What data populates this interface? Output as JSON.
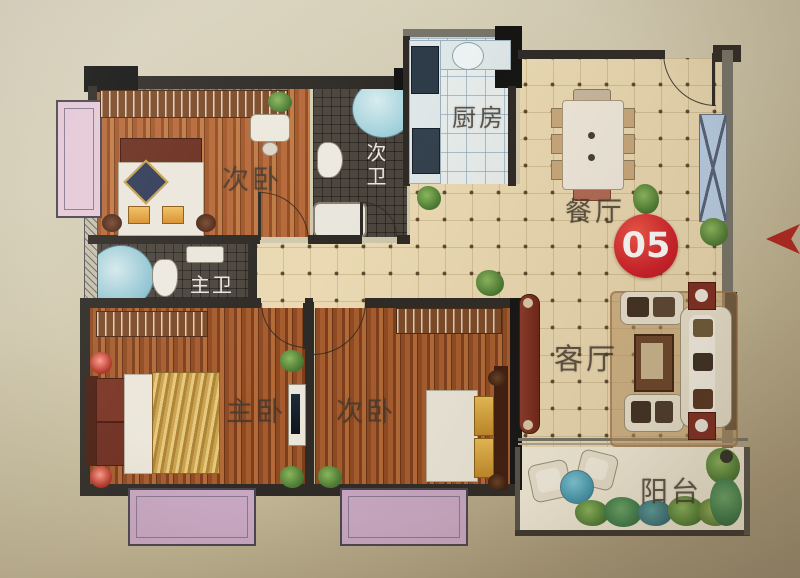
{
  "floorplan": {
    "unit_badge": "05",
    "rooms": [
      {
        "id": "bedroom-top",
        "label": "次卧"
      },
      {
        "id": "bath-secondary",
        "label": "次卫"
      },
      {
        "id": "kitchen",
        "label": "厨房"
      },
      {
        "id": "dining",
        "label": "餐厅"
      },
      {
        "id": "bath-master",
        "label": "主卫"
      },
      {
        "id": "bedroom-master",
        "label": "主卧"
      },
      {
        "id": "bedroom-second",
        "label": "次卧"
      },
      {
        "id": "living",
        "label": "客厅"
      },
      {
        "id": "balcony",
        "label": "阳台"
      }
    ],
    "marker": {
      "unit_number": "05",
      "direction_arrow": "left"
    },
    "colors": {
      "accent_red": "#d0202a",
      "wall_dark": "#2e2a26",
      "wood_floor": "#9a5228",
      "hall_tile": "#ead9b2",
      "bath_tile": "#4c453d",
      "kitchen_tile": "#e7edec",
      "bay_window": "#c9a8c4",
      "shaft_blue": "#b9cfe8"
    }
  }
}
